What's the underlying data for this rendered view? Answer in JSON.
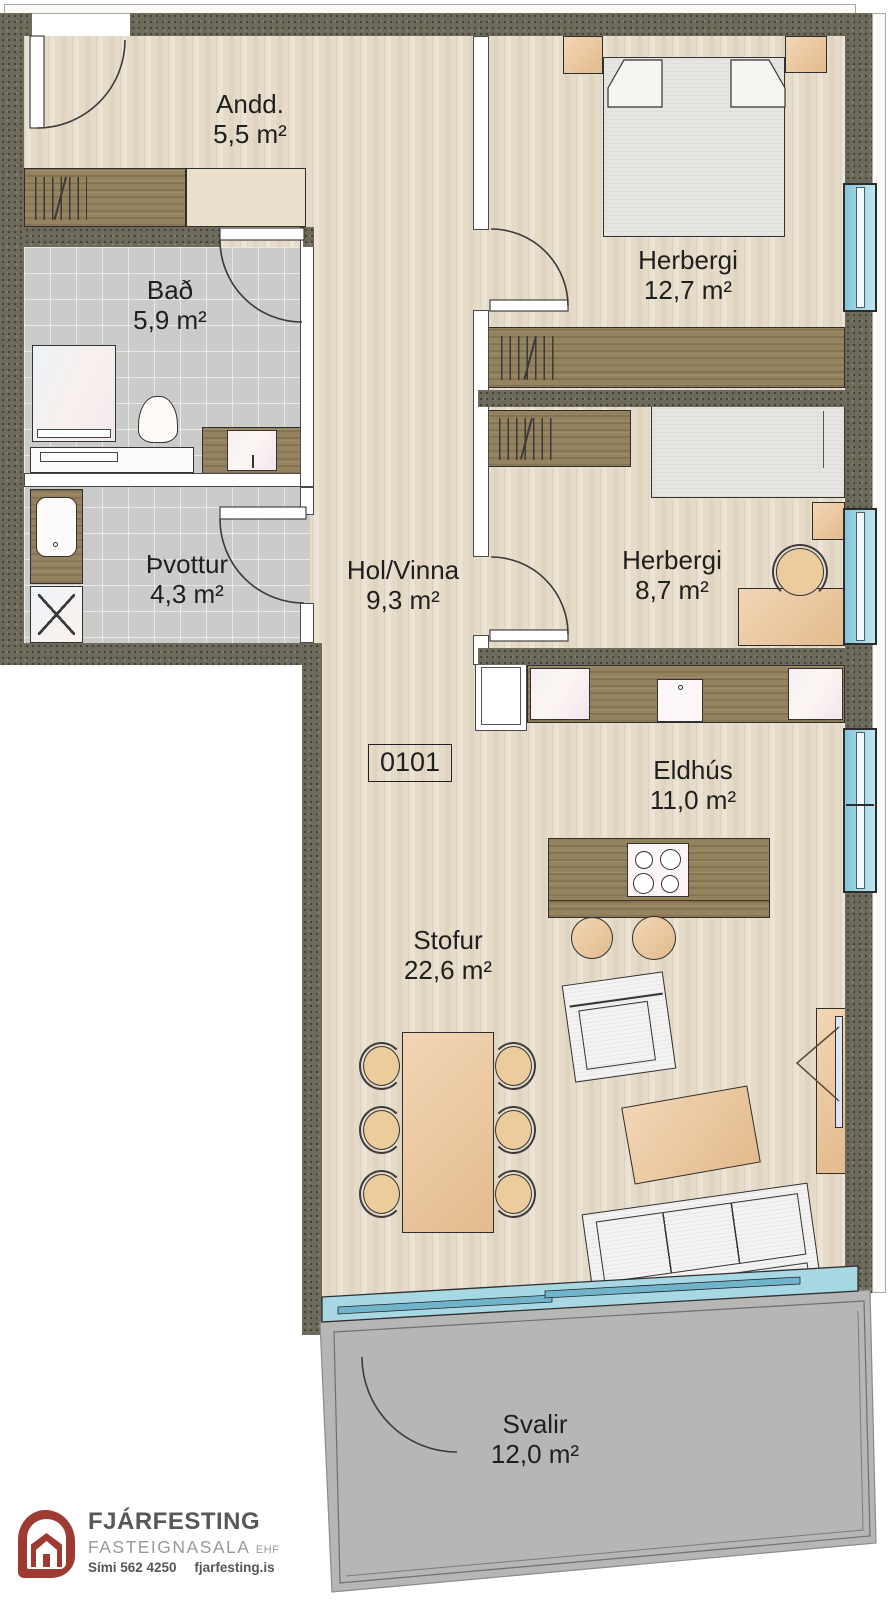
{
  "plan": {
    "unit_number": "0101",
    "rooms": [
      {
        "id": "andd",
        "name": "Andd.",
        "area": "5,5 m²"
      },
      {
        "id": "bad",
        "name": "Bað",
        "area": "5,9 m²"
      },
      {
        "id": "thvottur",
        "name": "Þvottur",
        "area": "4,3 m²"
      },
      {
        "id": "hol-vinna",
        "name": "Hol/Vinna",
        "area": "9,3 m²"
      },
      {
        "id": "herbergi-1",
        "name": "Herbergi",
        "area": "12,7 m²"
      },
      {
        "id": "herbergi-2",
        "name": "Herbergi",
        "area": "8,7 m²"
      },
      {
        "id": "eldhus",
        "name": "Eldhús",
        "area": "11,0 m²"
      },
      {
        "id": "stofur",
        "name": "Stofur",
        "area": "22,6 m²"
      },
      {
        "id": "svalir",
        "name": "Svalir",
        "area": "12,0 m²"
      }
    ]
  },
  "branding": {
    "agency_name": "FJÁRFESTING",
    "agency_type": "FASTEIGNASALA",
    "agency_suffix": "EHF",
    "phone": "Sími 562 4250",
    "website": "fjarfesting.is"
  },
  "colors": {
    "wall": "#6e6a5b",
    "wood_floor": "#e5dbc8",
    "tile_floor": "#cbcbca",
    "balcony": "#b6b6b4",
    "window_glass": "#86c5da",
    "dark_wood": "#95825f",
    "light_furniture": "#ecc496",
    "logo_red": "#9d3b33",
    "label_text": "#1f1f1f"
  }
}
